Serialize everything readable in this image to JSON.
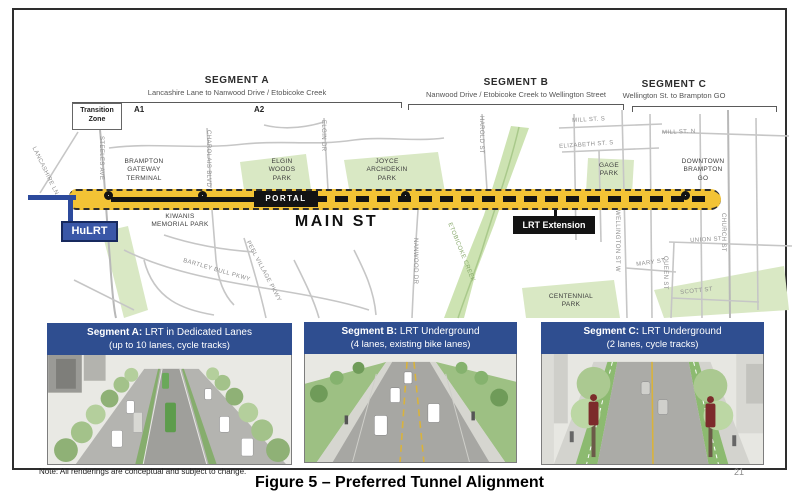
{
  "figure": {
    "caption": "Figure 5 – Preferred Tunnel Alignment",
    "note": "Note: All renderings are conceptual and subject to change.",
    "page_number": "21"
  },
  "brackets": [
    {
      "title": "SEGMENT A",
      "subtitle": "Lancashire Lane to Nanwood Drive / Etobicoke Creek"
    },
    {
      "title": "SEGMENT B",
      "subtitle": "Nanwood Drive / Etobicoke Creek to Wellington Street"
    },
    {
      "title": "SEGMENT C",
      "subtitle": "Wellington St. to Brampton GO"
    }
  ],
  "subzones": {
    "transition": "Transition\nZone",
    "a1": "A1",
    "a2": "A2"
  },
  "map": {
    "main_st": "MAIN ST",
    "portal": "PORTAL",
    "lrt_extension": "LRT Extension",
    "hulrt": "HuLRT",
    "colors": {
      "corridor_yellow": "#F3C335",
      "hulrt_blue": "#3A57A7",
      "banner_blue": "#2F4E90",
      "park_green": "#D9E8C4"
    },
    "streets": [
      {
        "text": "LANCASHIRE LN"
      },
      {
        "text": "STEELES AVE"
      },
      {
        "text": "CHAROLAIS BLVD"
      },
      {
        "text": "ELGIN DR"
      },
      {
        "text": "NANWOOD DR"
      },
      {
        "text": "HAROLD ST"
      },
      {
        "text": "MILL ST. S"
      },
      {
        "text": "ELIZABETH ST. S"
      },
      {
        "text": "MILL ST. N"
      },
      {
        "text": "WELLINGTON ST W"
      },
      {
        "text": "CHURCH ST"
      },
      {
        "text": "UNION ST"
      },
      {
        "text": "MARY ST"
      },
      {
        "text": "QUEEN ST"
      },
      {
        "text": "SCOTT ST"
      },
      {
        "text": "BARTLEY BULL PKWY"
      },
      {
        "text": "PEEL VILLAGE PKWY"
      },
      {
        "text": "ETOBICOKE CREEK"
      }
    ],
    "places": [
      {
        "text": "BRAMPTON\nGATEWAY\nTERMINAL"
      },
      {
        "text": "KIWANIS\nMEMORIAL PARK"
      },
      {
        "text": "ELGIN\nWOODS\nPARK"
      },
      {
        "text": "JOYCE\nARCHDEKIN\nPARK"
      },
      {
        "text": "GAGE\nPARK"
      },
      {
        "text": "CENTENNIAL\nPARK"
      },
      {
        "text": "DOWNTOWN\nBRAMPTON\nGO"
      }
    ]
  },
  "cards": [
    {
      "heading_bold": "Segment A:",
      "heading_rest": " LRT in Dedicated Lanes",
      "subheading": "(up to 10 lanes, cycle tracks)"
    },
    {
      "heading_bold": "Segment B:",
      "heading_rest": " LRT Underground",
      "subheading": "(4 lanes, existing bike lanes)"
    },
    {
      "heading_bold": "Segment C:",
      "heading_rest": " LRT Underground",
      "subheading": "(2 lanes, cycle tracks)"
    }
  ]
}
